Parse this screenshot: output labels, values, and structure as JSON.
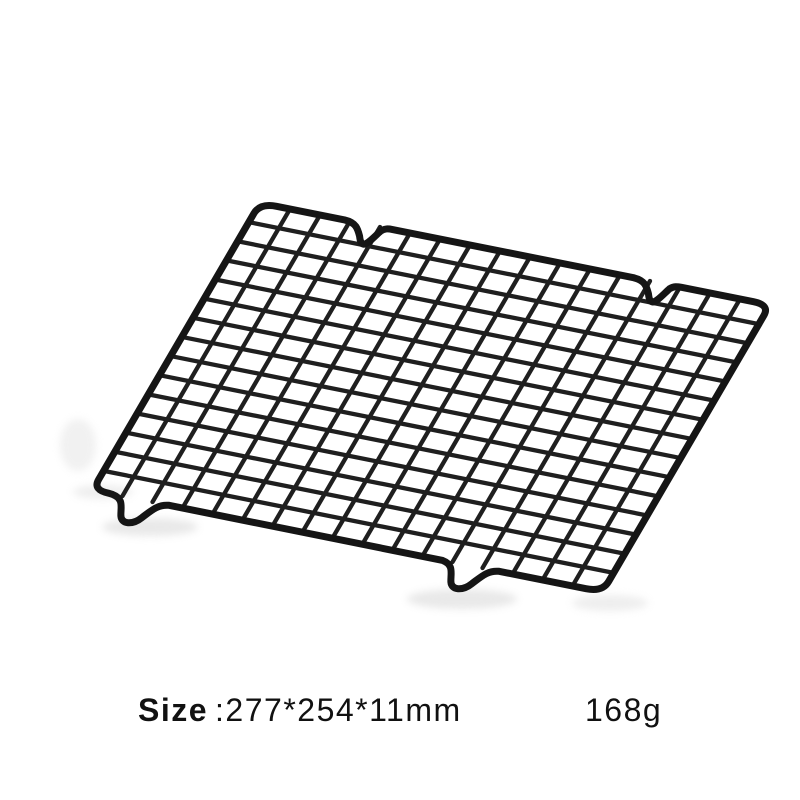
{
  "page": {
    "background_color": "#ffffff"
  },
  "product": {
    "description": "black wire grid baking cooling rack shown at an angle on white background",
    "rack": {
      "columns": 17,
      "rows": 15,
      "feet_count": 4,
      "wire_color": "#1f1f1f",
      "frame_color": "#151515",
      "shadow_color": "#c8c8c8"
    }
  },
  "caption": {
    "size_label": "Size",
    "size_value": ":277*254*11mm",
    "weight_value": "168g",
    "text_color": "#111111"
  }
}
